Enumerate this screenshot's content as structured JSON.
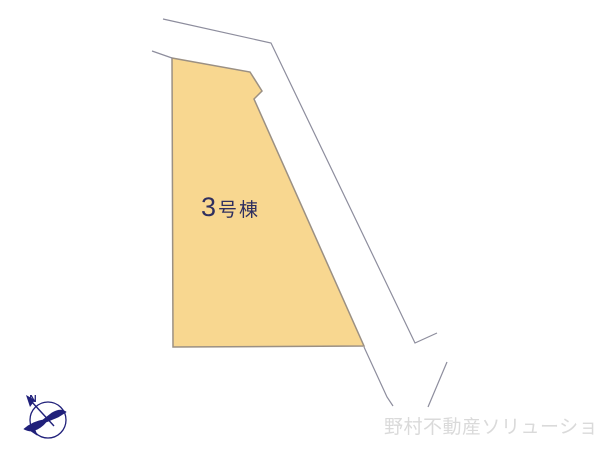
{
  "diagram": {
    "background": "#ffffff",
    "lot": {
      "name": "3号棟",
      "label_number": "3",
      "label_suffix": "号棟",
      "label_color": "#2f2f5f",
      "fill": "#f8d790",
      "stroke": "#9b9083",
      "points": "172,58 250,72 262,91 254,99 364,346 173,347"
    },
    "roads": {
      "stroke": "#8d8d9d",
      "outer_edge_points": "163,19 271,43 415,343 437,333",
      "upper_band_points": "152,51 172,58",
      "lower_extension_points": "364,347 387,397 393,406",
      "spur_points": "447,362 428,407"
    },
    "compass": {
      "color": "#20207a",
      "north_label": "N",
      "circle": {
        "cx": "48",
        "cy": "420",
        "r": "18"
      },
      "needle_points": "54,426 31,401",
      "arrowhead_points": "26,395 35,400 30,407",
      "bird_path": "M24,429 C30,424 36,421 43,420 L52,413 C57,410 62,409 66,412 L58,417 C53,419 49,421 46,422 C43,426 38,429 35,430 L37,435 L31,431 C28,431 26,430 24,429 Z"
    },
    "watermark": {
      "text": "野村不動産ソリューションズ",
      "color": "#dadada"
    }
  }
}
